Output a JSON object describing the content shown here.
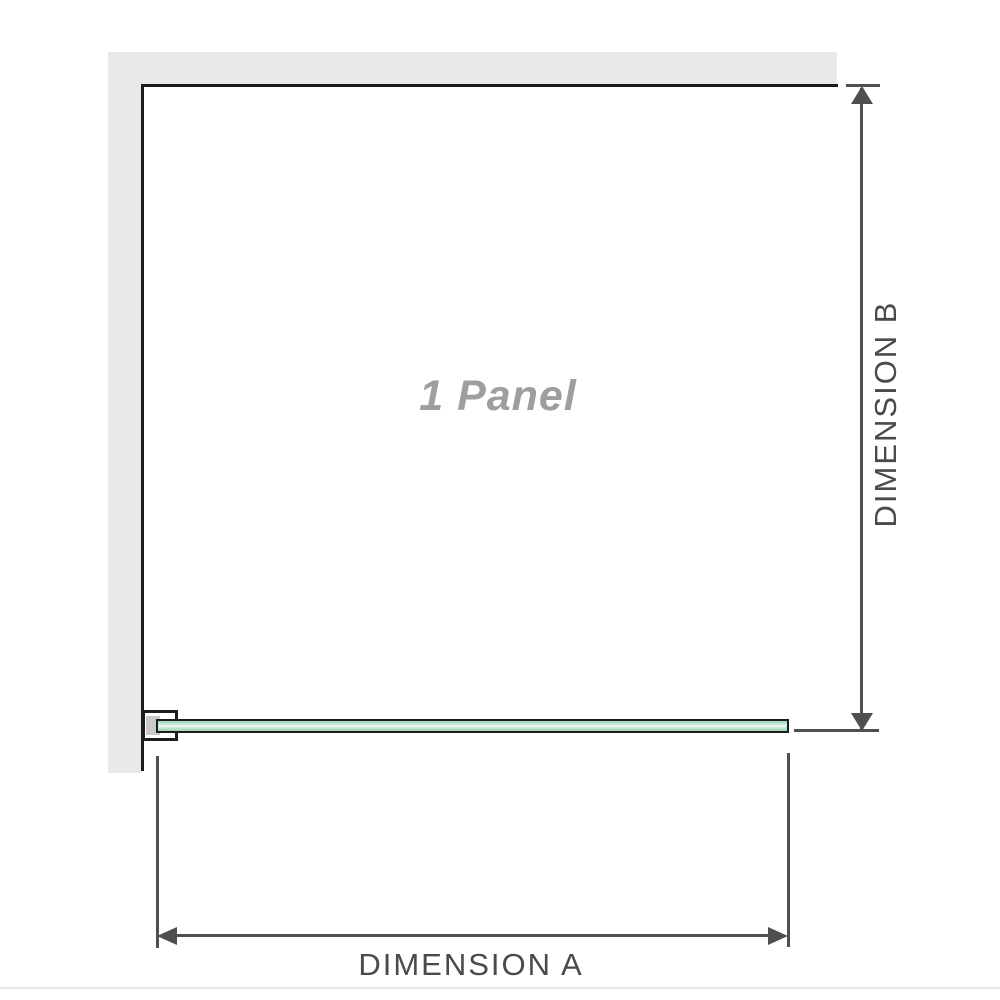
{
  "diagram": {
    "panel_label": "1 Panel",
    "dimension_a_label": "DIMENSION A",
    "dimension_b_label": "DIMENSION B",
    "colors": {
      "wall": "#e9e9e9",
      "outline": "#1c1c1c",
      "glass_green": "#9cd4b4",
      "glass_highlight": "#ecf8f1",
      "bracket_pad": "#c9c9c9",
      "dim_line": "#4f4f4f",
      "dim_text": "#4a4a4a",
      "panel_text": "#9e9e9e",
      "divider": "#e8e5e0"
    }
  }
}
